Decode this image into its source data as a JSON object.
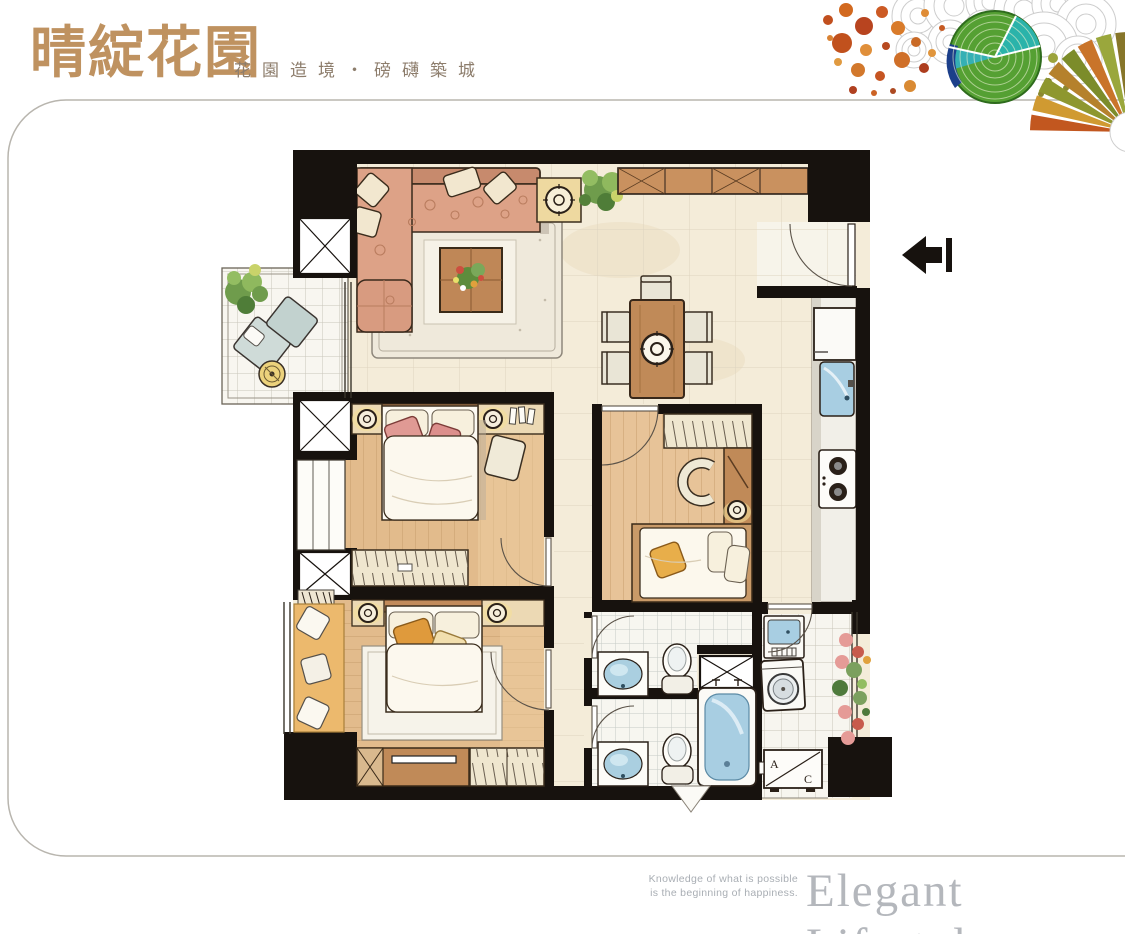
{
  "header": {
    "title": "晴綻花園",
    "subtitle": "花園造境・磅礴築城"
  },
  "footer": {
    "tagline_line1": "Knowledge of what is possible",
    "tagline_line2": "is the beginning of happiness.",
    "slogan": "Elegant Lifestyle"
  },
  "floorplan": {
    "ac_unit": {
      "label_a": "A",
      "label_c": "C"
    },
    "colors": {
      "wall_black": "#17120e",
      "tile_cream": "#f4ecd9",
      "wood_floor": "#e2bb8c",
      "sofa_salmon": "#dda287",
      "fixture_blue": "#a8cee2",
      "lamp_yellow": "#eed9a0",
      "plant_green": "#6f9c4c",
      "title_gold": "#bf9260",
      "slogan_gray": "#b4b7bc"
    }
  }
}
